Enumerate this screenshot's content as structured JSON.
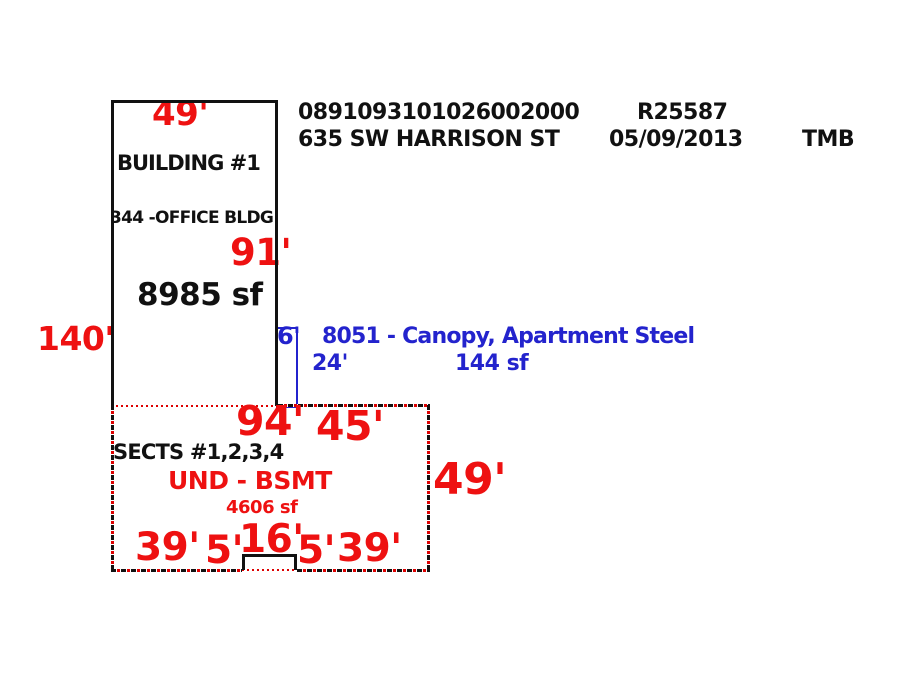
{
  "header": {
    "parcel_id": "0891093101026002000",
    "record_id": "R25587",
    "address": "635 SW HARRISON ST",
    "date": "05/09/2013",
    "initials": "TMB"
  },
  "building1": {
    "name": "BUILDING #1",
    "type_label": "344 -OFFICE BLDG",
    "area": "8985 sf",
    "dim_top": "49'",
    "dim_right": "91'",
    "dim_left": "140'"
  },
  "canopy": {
    "label": "8051 - Canopy, Apartment Steel",
    "dim_width": "6'",
    "dim_height": "24'",
    "area": "144 sf"
  },
  "basement": {
    "name": "SECTS #1,2,3,4",
    "type_label": "UND - BSMT",
    "area": "4606 sf",
    "dim_top": "94'",
    "dim_top_right": "45'",
    "dim_right": "49'",
    "bottom_dims": [
      "39'",
      "5'",
      "16'",
      "5'",
      "39'"
    ]
  },
  "colors": {
    "dimension_red": "#ee1111",
    "canopy_blue": "#2323cd",
    "outline_black": "#111111",
    "dotted_red": "#dd0000",
    "background": "#ffffff"
  }
}
